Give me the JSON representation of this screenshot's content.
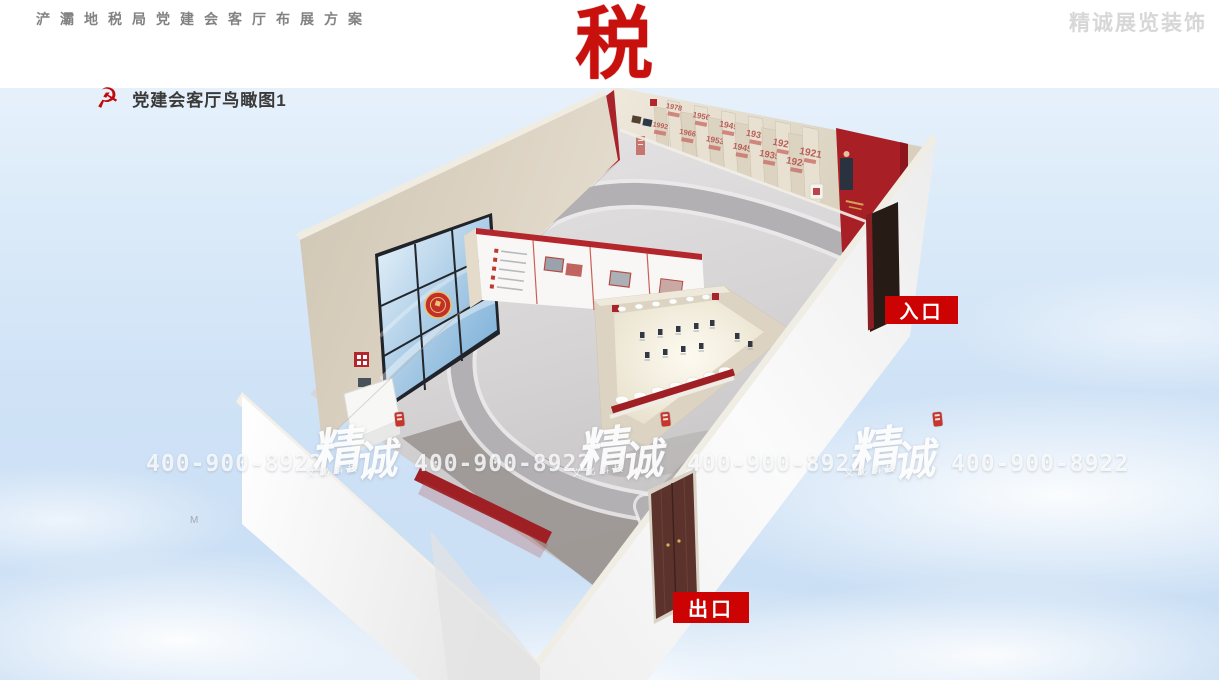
{
  "header": {
    "project_title": "浐灞地税局党建会客厅布展方案",
    "company_watermark": "精诚展览装饰",
    "tax_seal_character": "税"
  },
  "section": {
    "icon": "party-emblem-icon",
    "title": "党建会客厅鸟瞰图1"
  },
  "annotations": {
    "entrance_label": "入口",
    "exit_label": "出口"
  },
  "watermarks": {
    "phone_number": "400-900-8922",
    "brand_char_1": "精",
    "brand_char_2": "诚",
    "brand_subtitle": "文化科技",
    "stray_letter": "M"
  },
  "room": {
    "timeline_wall_years": [
      "1992",
      "1978",
      "1966",
      "1956",
      "1953",
      "1949",
      "1945",
      "1937",
      "1935",
      "1927",
      "1924",
      "1921"
    ]
  },
  "colors": {
    "accent_red": "#cc0302",
    "deep_wall_red": "#a8242a",
    "cream_panel": "#ddd5c3",
    "sky_blue": "#d9e8f8",
    "floor_gray": "#b2b0b3",
    "watermark_gray": "#d7d7d7",
    "title_gray": "#828282"
  }
}
